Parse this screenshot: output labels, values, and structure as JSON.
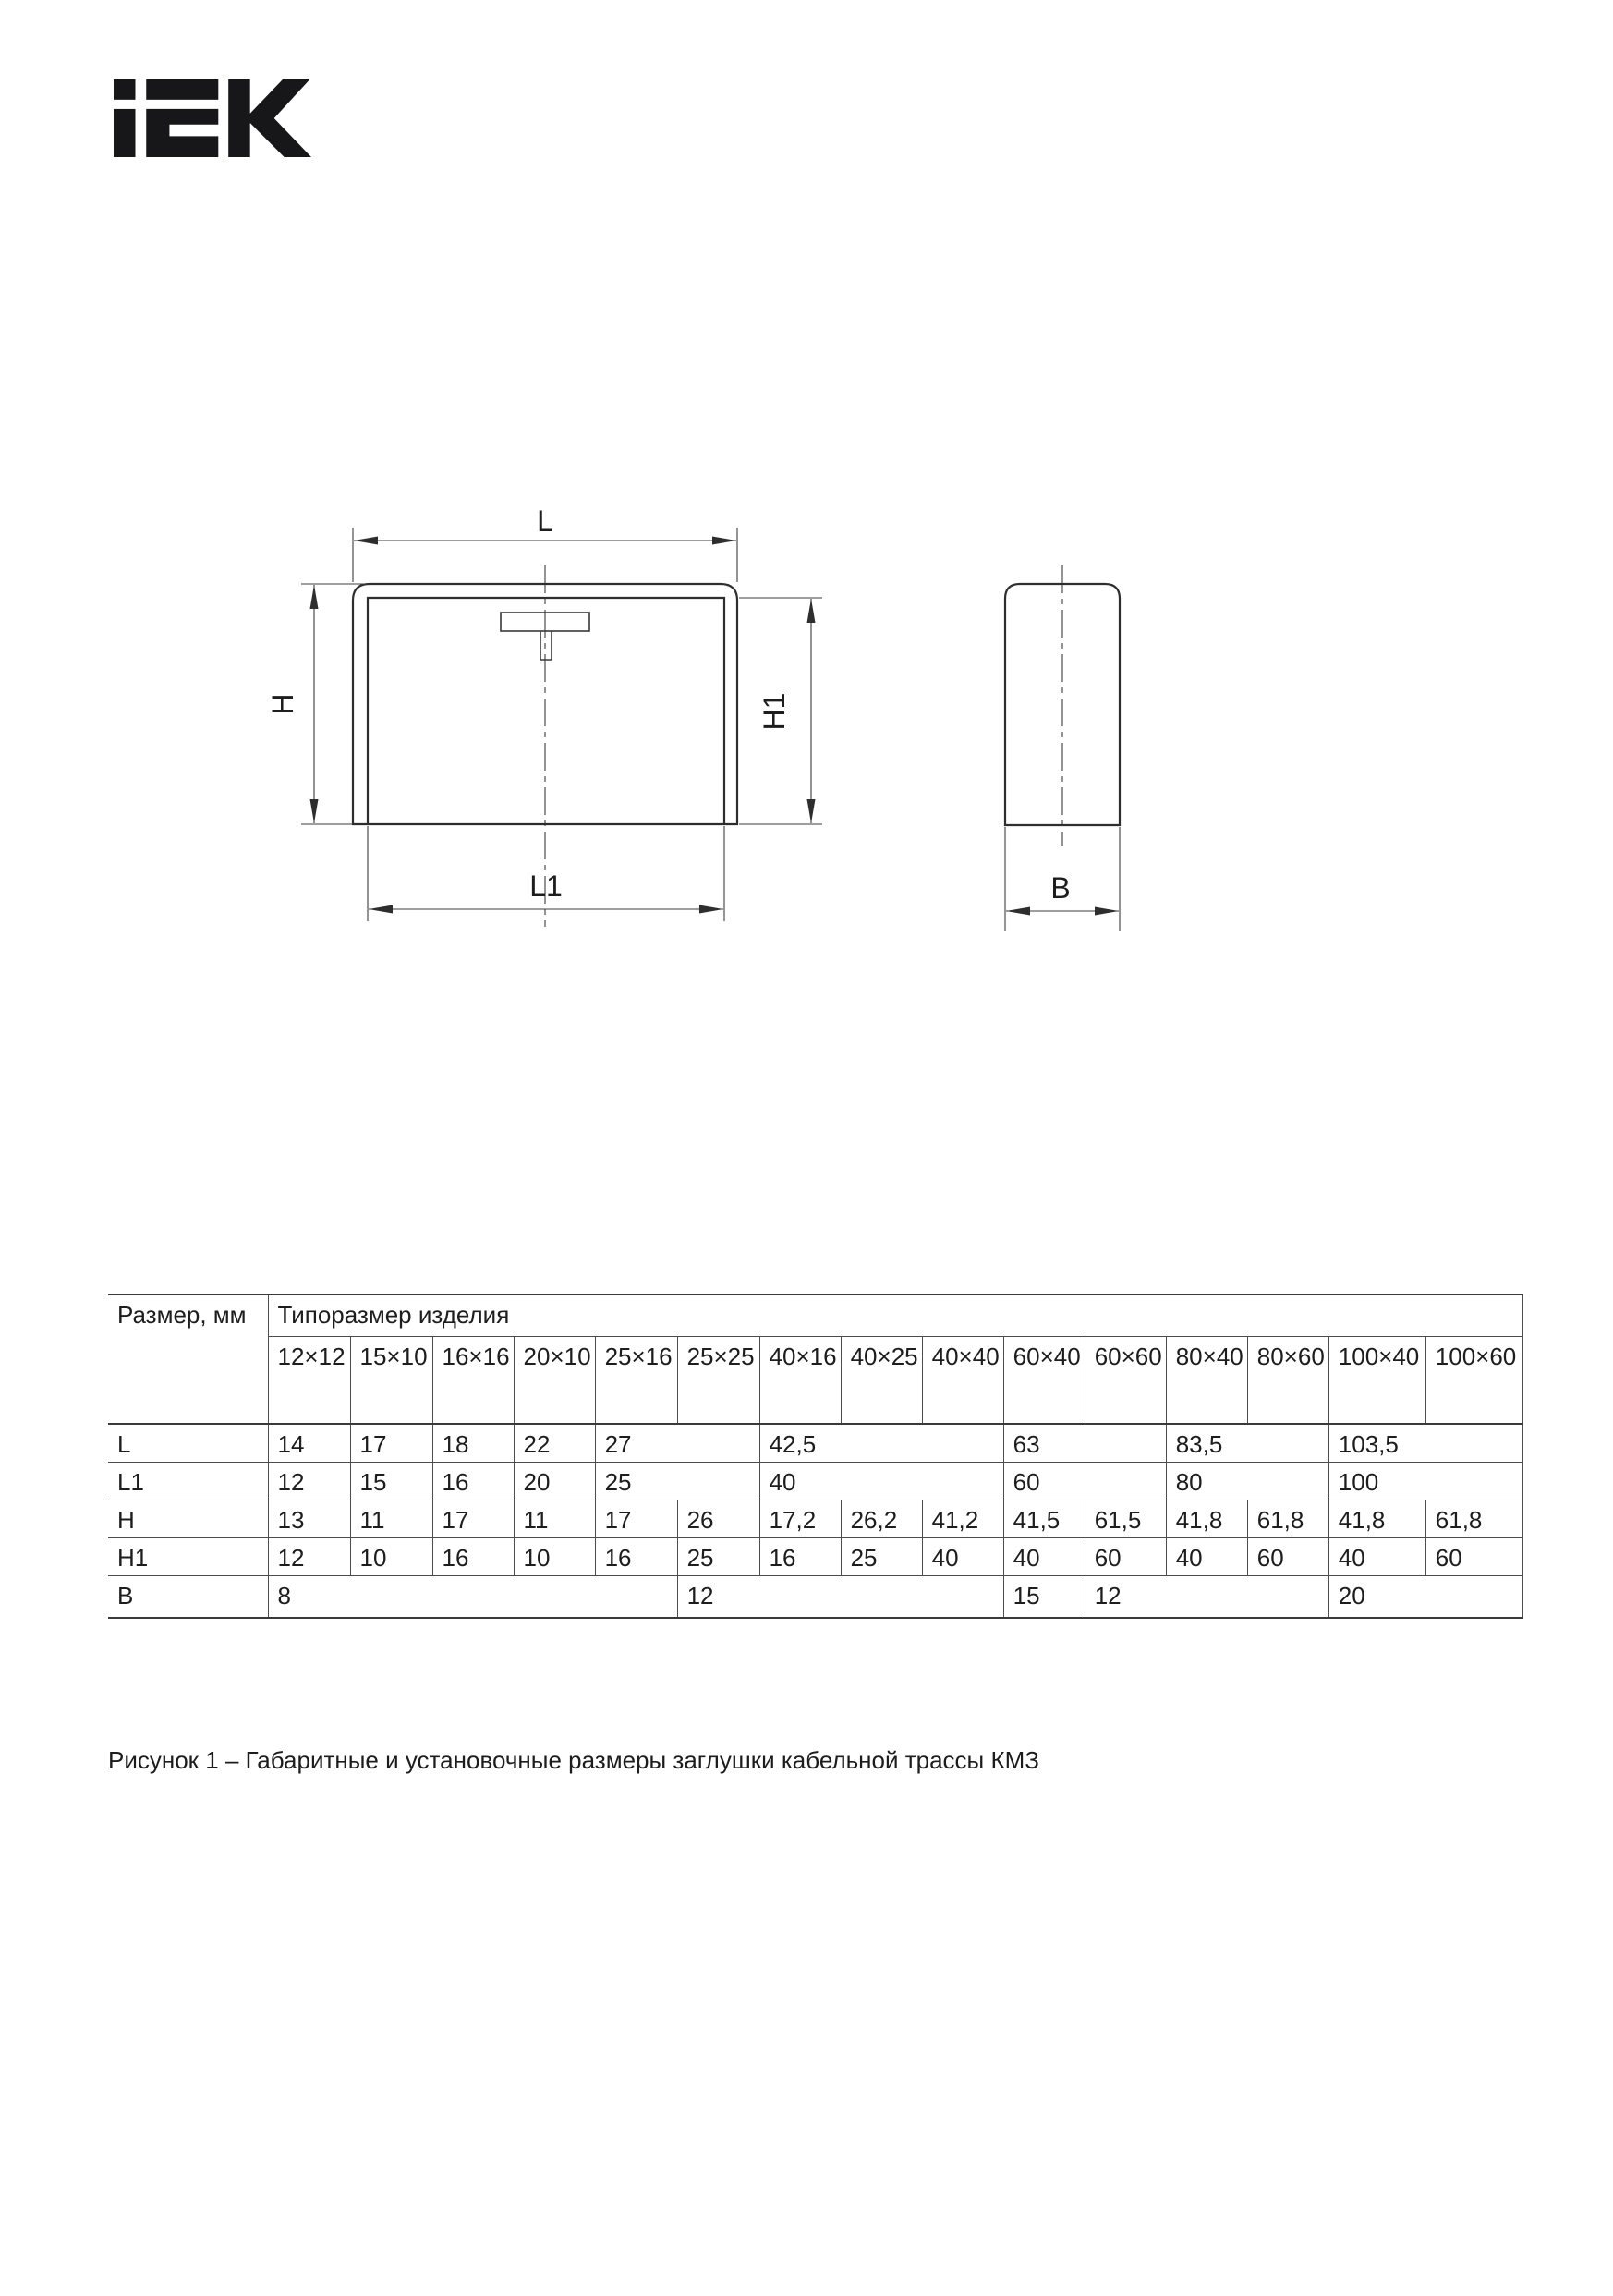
{
  "figure": {
    "caption": "Рисунок 1 – Габаритные и установочные размеры заглушки кабельной трассы КМЗ"
  },
  "logo": {
    "brand": "IEK"
  },
  "drawing": {
    "front_view": {
      "width_label": "L",
      "inner_width_label": "L1",
      "height_label": "H",
      "inner_height_label": "H1"
    },
    "side_view": {
      "depth_label": "B"
    }
  },
  "table": {
    "corner_header": "Размер, мм",
    "group_header": "Типоразмер изделия",
    "size_headers": [
      "12×12",
      "15×10",
      "16×16",
      "20×10",
      "25×16",
      "25×25",
      "40×16",
      "40×25",
      "40×40",
      "60×40",
      "60×60",
      "80×40",
      "80×60",
      "100×40",
      "100×60"
    ],
    "rows": [
      {
        "label": "L",
        "cells": [
          {
            "v": "14",
            "span": 1
          },
          {
            "v": "17",
            "span": 1
          },
          {
            "v": "18",
            "span": 1
          },
          {
            "v": "22",
            "span": 1
          },
          {
            "v": "27",
            "span": 2
          },
          {
            "v": "42,5",
            "span": 3
          },
          {
            "v": "63",
            "span": 2
          },
          {
            "v": "83,5",
            "span": 2
          },
          {
            "v": "103,5",
            "span": 2
          }
        ]
      },
      {
        "label": "L1",
        "cells": [
          {
            "v": "12",
            "span": 1
          },
          {
            "v": "15",
            "span": 1
          },
          {
            "v": "16",
            "span": 1
          },
          {
            "v": "20",
            "span": 1
          },
          {
            "v": "25",
            "span": 2
          },
          {
            "v": "40",
            "span": 3
          },
          {
            "v": "60",
            "span": 2
          },
          {
            "v": "80",
            "span": 2
          },
          {
            "v": "100",
            "span": 2
          }
        ]
      },
      {
        "label": "H",
        "cells": [
          {
            "v": "13",
            "span": 1
          },
          {
            "v": "11",
            "span": 1
          },
          {
            "v": "17",
            "span": 1
          },
          {
            "v": "11",
            "span": 1
          },
          {
            "v": "17",
            "span": 1
          },
          {
            "v": "26",
            "span": 1
          },
          {
            "v": "17,2",
            "span": 1
          },
          {
            "v": "26,2",
            "span": 1
          },
          {
            "v": "41,2",
            "span": 1
          },
          {
            "v": "41,5",
            "span": 1
          },
          {
            "v": "61,5",
            "span": 1
          },
          {
            "v": "41,8",
            "span": 1
          },
          {
            "v": "61,8",
            "span": 1
          },
          {
            "v": "41,8",
            "span": 1
          },
          {
            "v": "61,8",
            "span": 1
          }
        ]
      },
      {
        "label": "H1",
        "cells": [
          {
            "v": "12",
            "span": 1
          },
          {
            "v": "10",
            "span": 1
          },
          {
            "v": "16",
            "span": 1
          },
          {
            "v": "10",
            "span": 1
          },
          {
            "v": "16",
            "span": 1
          },
          {
            "v": "25",
            "span": 1
          },
          {
            "v": "16",
            "span": 1
          },
          {
            "v": "25",
            "span": 1
          },
          {
            "v": "40",
            "span": 1
          },
          {
            "v": "40",
            "span": 1
          },
          {
            "v": "60",
            "span": 1
          },
          {
            "v": "40",
            "span": 1
          },
          {
            "v": "60",
            "span": 1
          },
          {
            "v": "40",
            "span": 1
          },
          {
            "v": "60",
            "span": 1
          }
        ]
      },
      {
        "label": "B",
        "cells": [
          {
            "v": "8",
            "span": 5
          },
          {
            "v": "12",
            "span": 4
          },
          {
            "v": "15",
            "span": 1
          },
          {
            "v": "12",
            "span": 3
          },
          {
            "v": "20",
            "span": 2
          }
        ]
      }
    ]
  }
}
